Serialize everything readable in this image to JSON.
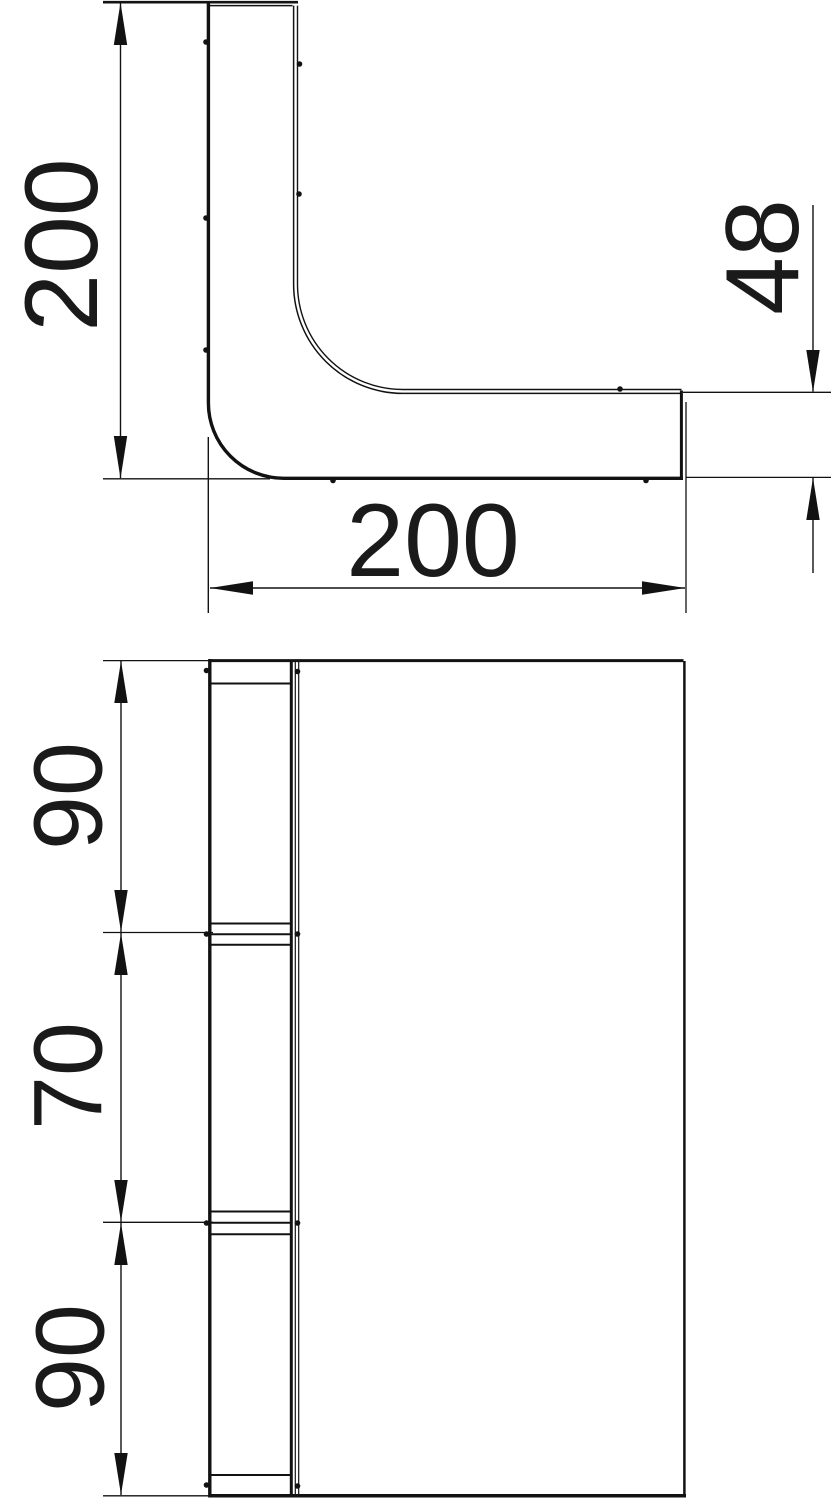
{
  "drawing": {
    "title": "90 degree bend fitting - two orthographic views",
    "colors": {
      "ink": "#121212",
      "paper": "#ffffff"
    },
    "side_view": {
      "description": "side elevation of L-shaped bend profile",
      "dims": {
        "height": {
          "value": "200"
        },
        "width": {
          "value": "200"
        },
        "end_height": {
          "value": "48"
        }
      }
    },
    "plan_view": {
      "description": "plan view with side rail segmented in three sections",
      "dims": {
        "segment_top": {
          "value": "90"
        },
        "segment_middle": {
          "value": "70"
        },
        "segment_bottom": {
          "value": "90"
        }
      }
    }
  }
}
